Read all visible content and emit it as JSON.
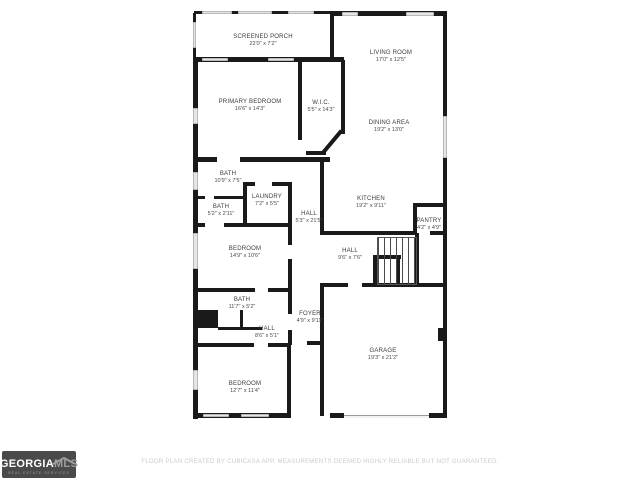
{
  "plan": {
    "rooms": [
      {
        "name": "SCREENED PORCH",
        "dims": "22'0\" x 7'2\""
      },
      {
        "name": "LIVING ROOM",
        "dims": "17'0\" x 12'5\""
      },
      {
        "name": "PRIMARY BEDROOM",
        "dims": "16'6\" x 14'3\""
      },
      {
        "name": "W.I.C.",
        "dims": "5'5\" x 14'3\""
      },
      {
        "name": "DINING AREA",
        "dims": "19'2\" x 13'0\""
      },
      {
        "name": "BATH",
        "dims": "10'9\" x 7'5\""
      },
      {
        "name": "LAUNDRY",
        "dims": "7'2\" x 5'5\""
      },
      {
        "name": "BATH",
        "dims": "5'2\" x 2'11\""
      },
      {
        "name": "HALL",
        "dims": "5'3\" x 21'5\""
      },
      {
        "name": "KITCHEN",
        "dims": "19'2\" x 9'11\""
      },
      {
        "name": "PANTRY",
        "dims": "4'2\" x 4'9\""
      },
      {
        "name": "BEDROOM",
        "dims": "14'9\" x 10'6\""
      },
      {
        "name": "HALL",
        "dims": "9'6\" x 7'6\""
      },
      {
        "name": "BATH",
        "dims": "11'7\" x 5'2\""
      },
      {
        "name": "FOYER",
        "dims": "4'9\" x 9'11\""
      },
      {
        "name": "HALL",
        "dims": "8'6\" x 5'1\""
      },
      {
        "name": "BEDROOM",
        "dims": "12'7\" x 11'4\""
      },
      {
        "name": "GARAGE",
        "dims": "19'3\" x 21'2\""
      }
    ]
  },
  "footer": {
    "logo": {
      "brand_primary": "GEORGIA",
      "brand_secondary": "MLS",
      "tagline": "REAL ESTATE SERVICES"
    },
    "disclaimer": "FLOOR PLAN CREATED BY CUBICASA APP, MEASUREMENTS DEEMED HIGHLY RELIABLE BUT NOT GUARANTEED."
  },
  "colors": {
    "wall": "#1a1a1a",
    "window": "#e6e6e6",
    "logo_bg": "#4a4a4a",
    "logo_secondary": "#9b9fa2",
    "disclaimer_text": "#cbcbcb"
  }
}
